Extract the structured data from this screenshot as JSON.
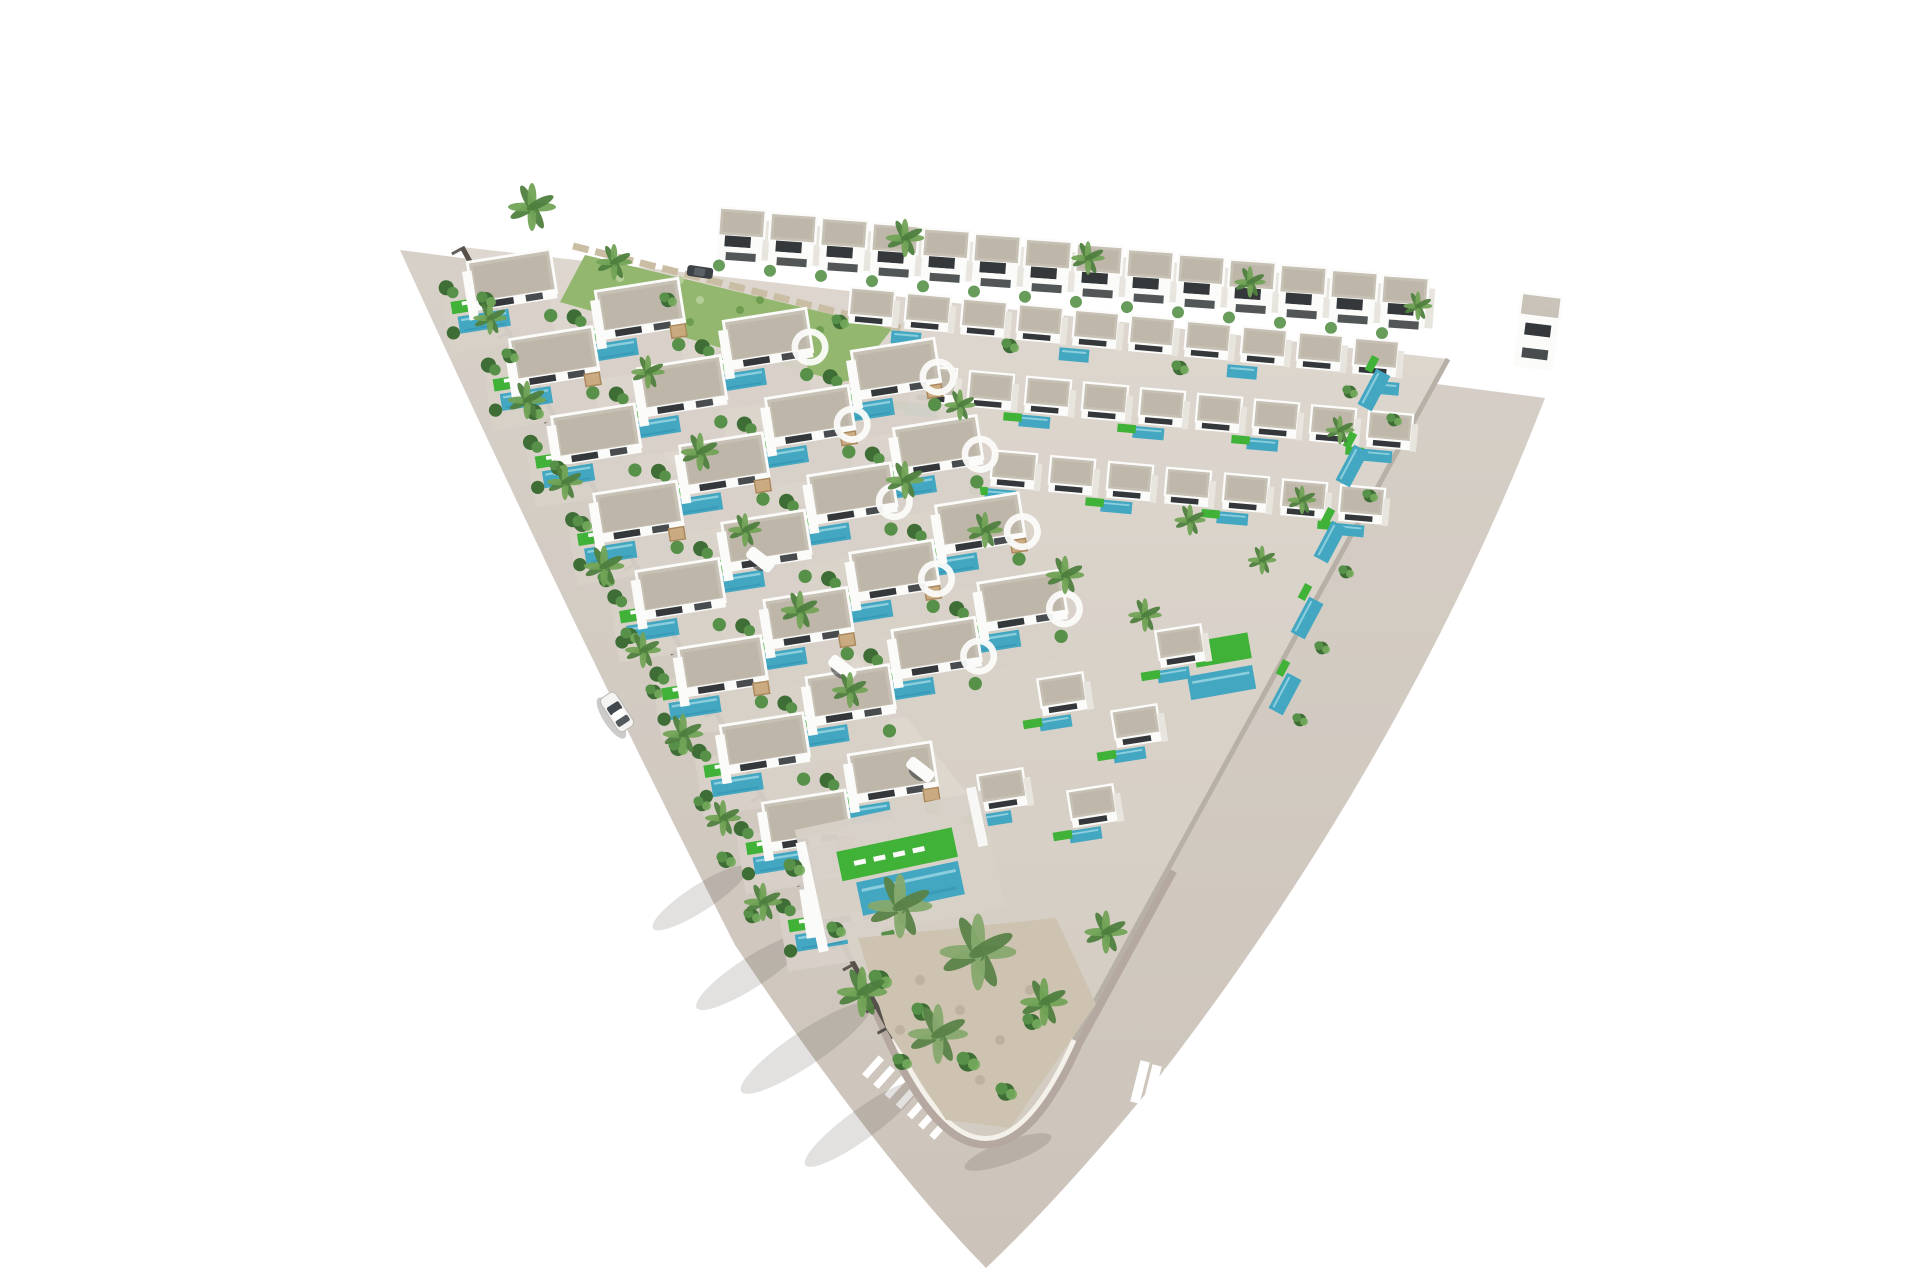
{
  "palette": {
    "background": "#ffffff",
    "roadTop": "#d7d0c8",
    "roadBottom": "#ccc4ba",
    "paver": "#b5a8a1",
    "plotTop": "#ded7cf",
    "plotBottom": "#d3ccc2",
    "terrace": "#d8d1c8",
    "wallDark": "#56514b",
    "tickDark": "#3e3a35",
    "wallRight": "#b7b0a6",
    "curb": "#f4f1ea",
    "white": "#fbfbf9",
    "shade": "#e8e5df",
    "roof": "#c7c0b4",
    "roofDark": "#b2aa9c",
    "open": "#34383b",
    "pool": "#44a7c1",
    "poolDeep": "#2f8fb0",
    "poolLight": "#9ed8e3",
    "lawn": "#3fb237",
    "garden": "#93b76e",
    "gardenDot": "#6a9a4c",
    "gardenDotLight": "#b9cf9b",
    "gravel": "#cdc3b0",
    "gravelDot": "#b9ae98",
    "stone": "#c9bda3",
    "shrub1": "#3f6d36",
    "shrub2": "#579149",
    "shrub3": "#74ab5c",
    "palmD": "#4f7f3f",
    "palmL": "#72a356",
    "palmPaleD": "#5a8248",
    "palmPaleL": "#86a96e",
    "trunk": "#9b8a6b",
    "pergola": "#c9a87c",
    "pergolaEdge": "#a9885c",
    "shadowCol": "#4a443e",
    "carBody": "#f4f4f2",
    "carEdge": "#bdbab4",
    "carGlass": "#41484d",
    "walkway": "#ded7ce",
    "crosswalk": "#ffffff"
  },
  "layout": {
    "road_path": "M 400 250 L 1545 398 Q 1404 762 1152 1086 Q 1062 1196 986 1268 Q 878 1158 735 945 Q 568 618 400 250 Z",
    "plot_path": "M 462 247 L 1448 359 L 1074 1040 Q 986 1238 894 1038 Z",
    "paver_path": "M 1168 868 L 1074 1040 Q 986 1238 894 1038 L 822 872",
    "curb_tip_path": "M 1074 1040 Q 986 1238 894 1038",
    "wall_left": [
      462,
      247,
      894,
      1038
    ],
    "wall_right": [
      1448,
      359,
      1074,
      1040
    ],
    "garden_tl": "585,255 892,329 848,384 560,302",
    "garden_speckles": [
      [
        620,
        278
      ],
      [
        660,
        290
      ],
      [
        700,
        300
      ],
      [
        740,
        310
      ],
      [
        780,
        320
      ],
      [
        820,
        330
      ],
      [
        640,
        310
      ],
      [
        690,
        322
      ],
      [
        750,
        336
      ],
      [
        800,
        348
      ],
      [
        680,
        280
      ],
      [
        760,
        300
      ]
    ],
    "stone_wall": [
      573,
      246,
      905,
      329
    ],
    "spine": [
      652,
      418,
      965,
      812
    ],
    "arch_bridges": [
      [
        760,
        560
      ],
      [
        842,
        668
      ],
      [
        920,
        770
      ]
    ],
    "back_row": {
      "x": 742,
      "y": 223,
      "n": 14,
      "dx": 51,
      "dy": 5.2,
      "rot": 4,
      "s": 1
    },
    "r1_pools": [
      [
        906,
        338
      ],
      [
        1074,
        355
      ],
      [
        1242,
        372
      ],
      [
        1384,
        388
      ]
    ],
    "cluster_rows": [
      {
        "x": 872,
        "y": 303,
        "n": 10,
        "dx": 56,
        "dy": 5.6,
        "pools": false
      },
      {
        "x": 934,
        "y": 381,
        "n": 9,
        "dx": 57,
        "dy": 5.7,
        "pools": true
      },
      {
        "x": 1014,
        "y": 466,
        "n": 7,
        "dx": 58,
        "dy": 5.8,
        "pools": true
      }
    ],
    "cluster_rot": 5,
    "cluster_s": 0.92,
    "edge_pools": [
      [
        1374,
        390
      ],
      [
        1352,
        466
      ],
      [
        1330,
        542
      ],
      [
        1307,
        618
      ],
      [
        1285,
        694
      ]
    ],
    "edge_pool_rot": -62,
    "lawn_feature": {
      "x": 1222,
      "y": 650,
      "rot": -10
    },
    "extra_units": [
      [
        1180,
        642
      ],
      [
        1136,
        722
      ],
      [
        1092,
        802
      ],
      [
        1062,
        690
      ],
      [
        1002,
        786
      ]
    ],
    "cols": [
      {
        "x": 500,
        "y": 287,
        "n": 9
      },
      {
        "x": 628,
        "y": 316,
        "n": 7
      },
      {
        "x": 756,
        "y": 346,
        "n": 5
      },
      {
        "x": 884,
        "y": 376,
        "n": 4
      }
    ],
    "col_dir": [
      0.479,
      0.878
    ],
    "col_step": 88,
    "unit_rot": -9,
    "unit_s": 0.95,
    "tip_terrace": {
      "x": 900,
      "y": 868,
      "rot": -12
    },
    "tip_garden": "858 938 1056 918 1096 1004 1010 1128 946 1120 886 1028",
    "tip_gravel_dots": [
      [
        920,
        980
      ],
      [
        960,
        1010
      ],
      [
        1000,
        1040
      ],
      [
        900,
        1030
      ],
      [
        980,
        1080
      ],
      [
        1030,
        990
      ]
    ],
    "palms": [
      [
        532,
        207,
        1.0
      ],
      [
        614,
        262,
        0.75
      ],
      [
        905,
        238,
        0.8
      ],
      [
        1088,
        258,
        0.7
      ],
      [
        1250,
        282,
        0.65
      ],
      [
        1418,
        306,
        0.6
      ],
      [
        490,
        318,
        0.7
      ],
      [
        527,
        400,
        0.8
      ],
      [
        565,
        482,
        0.75
      ],
      [
        604,
        566,
        0.85
      ],
      [
        643,
        650,
        0.75
      ],
      [
        683,
        734,
        0.85
      ],
      [
        723,
        818,
        0.75
      ],
      [
        763,
        902,
        0.8
      ],
      [
        648,
        372,
        0.7
      ],
      [
        700,
        452,
        0.8
      ],
      [
        745,
        530,
        0.7
      ],
      [
        800,
        610,
        0.8
      ],
      [
        850,
        690,
        0.75
      ],
      [
        905,
        480,
        0.8
      ],
      [
        985,
        530,
        0.75
      ],
      [
        1065,
        575,
        0.8
      ],
      [
        1145,
        615,
        0.7
      ],
      [
        960,
        405,
        0.65
      ],
      [
        1190,
        520,
        0.65
      ],
      [
        1262,
        560,
        0.6
      ],
      [
        900,
        906,
        1.35
      ],
      [
        978,
        952,
        1.6
      ],
      [
        938,
        1034,
        1.25
      ],
      [
        862,
        992,
        1.05
      ],
      [
        1044,
        1002,
        1.0
      ],
      [
        1106,
        932,
        0.9
      ],
      [
        1340,
        430,
        0.6
      ],
      [
        1302,
        500,
        0.6
      ]
    ],
    "shrubs": [
      [
        486,
        300,
        1
      ],
      [
        510,
        356,
        0.9
      ],
      [
        534,
        412,
        1
      ],
      [
        558,
        468,
        0.9
      ],
      [
        582,
        524,
        1
      ],
      [
        606,
        580,
        0.9
      ],
      [
        630,
        636,
        1
      ],
      [
        654,
        692,
        0.9
      ],
      [
        678,
        748,
        1
      ],
      [
        702,
        804,
        0.9
      ],
      [
        726,
        860,
        1
      ],
      [
        752,
        916,
        0.9
      ],
      [
        880,
        980,
        1.2
      ],
      [
        922,
        1012,
        1.1
      ],
      [
        968,
        1062,
        1.2
      ],
      [
        1006,
        1092,
        1.1
      ],
      [
        1032,
        1022,
        1
      ],
      [
        902,
        1062,
        1
      ],
      [
        1394,
        420,
        0.8
      ],
      [
        1370,
        496,
        0.8
      ],
      [
        1346,
        572,
        0.8
      ],
      [
        1322,
        648,
        0.8
      ],
      [
        1300,
        720,
        0.8
      ],
      [
        668,
        300,
        0.9
      ],
      [
        840,
        322,
        0.9
      ],
      [
        1010,
        346,
        0.9
      ],
      [
        1180,
        368,
        0.9
      ],
      [
        1350,
        392,
        0.8
      ],
      [
        794,
        868,
        1.1
      ],
      [
        836,
        930,
        1
      ]
    ],
    "shadows": [
      [
        700,
        898,
        56,
        13,
        -33
      ],
      [
        752,
        972,
        66,
        15,
        -33
      ],
      [
        806,
        1048,
        78,
        17,
        -34
      ],
      [
        862,
        1124,
        70,
        15,
        -36
      ],
      [
        1008,
        1152,
        46,
        11,
        -20
      ]
    ],
    "cw_left": {
      "x": 873,
      "y": 1067,
      "dx": 11.2,
      "dy": 10.2,
      "n": 7,
      "w": 25,
      "h": 7,
      "rot": -48
    },
    "cw_right": {
      "x": 1140,
      "y": 1082,
      "dx": 11.8,
      "dy": 4.8,
      "n": 12,
      "w": 9.5,
      "h": 50,
      "rot": 14
    },
    "giveway": {
      "x": 1424,
      "y": 356,
      "dx": 7,
      "dy": 7.5,
      "n": 4,
      "w": 9,
      "h": 3.5,
      "rot": -38
    },
    "car": {
      "x": 617,
      "y": 712,
      "rot": 57
    },
    "parked_car": {
      "x": 700,
      "y": 272,
      "rot": 8
    },
    "corner_building": {
      "x": 1538,
      "y": 328,
      "rot": 7
    }
  },
  "specs": {
    "bungalow": [
      [
        "rect",
        -6,
        30,
        112,
        62,
        "terrace",
        0.95
      ],
      [
        "rect",
        -30,
        14,
        48,
        13,
        "lawn",
        1
      ],
      [
        "rect",
        -38,
        11,
        9,
        4,
        "white",
        1
      ],
      [
        "rect",
        -25,
        11,
        9,
        4,
        "white",
        1
      ],
      [
        "rect",
        -22,
        33,
        54,
        18,
        "pool",
        1
      ],
      [
        "rect",
        -22,
        28,
        48,
        2.5,
        "poolLight",
        0.8
      ],
      [
        "rect",
        -22,
        39,
        44,
        2,
        "poolDeep",
        0.55
      ],
      [
        "rect",
        14,
        -8,
        88,
        46,
        "roof",
        1
      ],
      [
        "rect",
        14,
        -8,
        78,
        36,
        "roofDark",
        0.45
      ],
      [
        "srect",
        14,
        -8,
        88,
        46,
        "white",
        3
      ],
      [
        "rect",
        14,
        16,
        88,
        10,
        "white",
        1
      ],
      [
        "rect",
        -2,
        16,
        28,
        7,
        "open",
        1
      ],
      [
        "rect",
        34,
        16,
        18,
        7,
        "open",
        0.9
      ],
      [
        "rect",
        -32,
        4,
        10,
        52,
        "white",
        1
      ],
      [
        "circle",
        -56,
        -8,
        8,
        "shrub1",
        1
      ],
      [
        "circle",
        -50,
        -2,
        6,
        "shrub2",
        1
      ],
      [
        "circle",
        -56,
        40,
        7,
        "shrub1",
        1
      ],
      [
        "circle",
        48,
        38,
        7,
        "shrub2",
        1
      ]
    ],
    "pergola": [
      [
        "rect",
        50,
        24,
        16,
        13,
        "pergola",
        0.95
      ],
      [
        "srect",
        50,
        24,
        16,
        13,
        "pergolaEdge",
        1.5
      ]
    ],
    "flatUnit": [
      [
        "rect",
        0,
        0,
        48,
        30,
        "roof",
        1
      ],
      [
        "rect",
        0,
        0,
        40,
        22,
        "roofDark",
        0.4
      ],
      [
        "srect",
        0,
        0,
        48,
        30,
        "white",
        2.5
      ],
      [
        "rect",
        0,
        19,
        48,
        10,
        "white",
        1
      ],
      [
        "rect",
        -2,
        19,
        30,
        6,
        "open",
        1
      ],
      [
        "rect",
        27,
        10,
        7,
        30,
        "shade",
        1
      ]
    ],
    "flatPool": [
      [
        "rect",
        -12,
        33,
        34,
        13,
        "pool",
        1
      ],
      [
        "rect",
        -12,
        30,
        28,
        2,
        "poolLight",
        0.8
      ],
      [
        "rect",
        -36,
        30,
        20,
        9,
        "lawn",
        1
      ]
    ],
    "house2": [
      [
        "rect",
        0,
        24,
        46,
        26,
        "white",
        1
      ],
      [
        "rect",
        26,
        16,
        8,
        40,
        "shade",
        1
      ],
      [
        "rect",
        0,
        0,
        46,
        28,
        "roof",
        1
      ],
      [
        "rect",
        0,
        0,
        38,
        20,
        "roofDark",
        0.45
      ],
      [
        "srect",
        0,
        0,
        46,
        28,
        "white",
        2.5
      ],
      [
        "rect",
        -3,
        19,
        26,
        11,
        "open",
        1
      ],
      [
        "rect",
        -3,
        26,
        30,
        3,
        "white",
        1
      ],
      [
        "rect",
        1,
        34,
        30,
        8,
        "open",
        0.85
      ],
      [
        "circle",
        -20,
        44,
        6,
        "shrub2",
        0.9
      ]
    ],
    "poolTiny": [
      [
        "rect",
        0,
        0,
        30,
        13,
        "pool",
        1
      ],
      [
        "rect",
        0,
        -3,
        24,
        2,
        "poolLight",
        0.8
      ]
    ],
    "poolSmall": [
      [
        "rect",
        0,
        0,
        40,
        16,
        "pool",
        1
      ],
      [
        "rect",
        0,
        -4,
        34,
        2,
        "poolLight",
        0.8
      ],
      [
        "rect",
        22,
        -14,
        16,
        8,
        "lawn",
        1
      ]
    ],
    "lawnFeature": [
      [
        "rect",
        0,
        0,
        56,
        26,
        "lawn",
        1
      ],
      [
        "rect",
        -6,
        32,
        66,
        24,
        "pool",
        1
      ],
      [
        "rect",
        -6,
        27,
        58,
        2.5,
        "poolLight",
        0.8
      ]
    ],
    "tipTerrace": [
      [
        "rect",
        0,
        0,
        190,
        118,
        "terrace",
        0.97
      ],
      [
        "rect",
        0,
        -14,
        118,
        30,
        "lawn",
        1
      ],
      [
        "rect",
        -38,
        -14,
        12,
        5,
        "white",
        1
      ],
      [
        "rect",
        -18,
        -14,
        12,
        5,
        "white",
        1
      ],
      [
        "rect",
        2,
        -14,
        12,
        5,
        "white",
        1
      ],
      [
        "rect",
        22,
        -14,
        12,
        5,
        "white",
        1
      ],
      [
        "rect",
        6,
        22,
        104,
        34,
        "pool",
        1
      ],
      [
        "rect",
        6,
        14,
        96,
        3,
        "poolLight",
        0.8
      ],
      [
        "rect",
        6,
        31,
        90,
        3,
        "poolDeep",
        0.5
      ],
      [
        "rect",
        -92,
        10,
        10,
        112,
        "white",
        1
      ],
      [
        "rect",
        86,
        -34,
        10,
        60,
        "white",
        0.9
      ]
    ],
    "cornerBuilding": [
      [
        "rect",
        0,
        10,
        40,
        62,
        "white",
        1
      ],
      [
        "rect",
        0,
        -22,
        40,
        22,
        "roofDark",
        0.7
      ],
      [
        "srect",
        0,
        -22,
        40,
        22,
        "white",
        2.5
      ],
      [
        "rect",
        0,
        2,
        26,
        12,
        "open",
        1
      ],
      [
        "rect",
        0,
        26,
        26,
        10,
        "open",
        0.9
      ]
    ]
  }
}
